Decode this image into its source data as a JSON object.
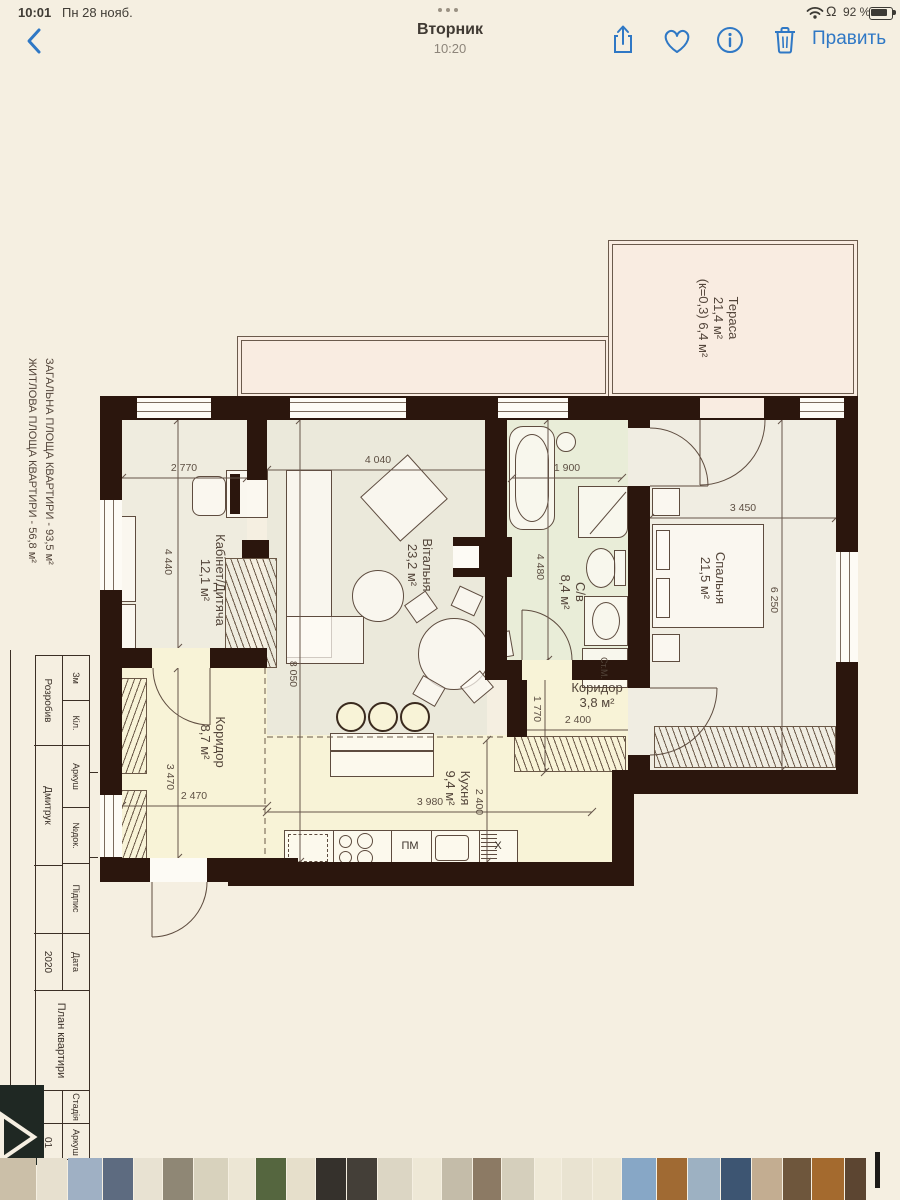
{
  "status_bar": {
    "time": "10:01",
    "date": "Пн 28 нояб.",
    "battery_percent": "92 %"
  },
  "nav": {
    "title": "Вторник",
    "subtitle": "10:20",
    "edit_label": "Править"
  },
  "plan": {
    "side_note_line1": "ЗАГАЛЬНА ПЛОЩА КВАРТИРИ - 93,5 м²",
    "side_note_line2": "ЖИТЛОВА ПЛОЩА КВАРТИРИ - 56,8 м²",
    "rooms": {
      "office": {
        "name": "Кабінет/Дитяча",
        "area": "12,1 м²"
      },
      "living": {
        "name": "Вітальня",
        "area": "23,2 м²"
      },
      "bath": {
        "name": "С/в",
        "area": "8,4 м²"
      },
      "bedroom": {
        "name": "Спальня",
        "area": "21,5 м²"
      },
      "hall": {
        "name": "Коридор",
        "area": "8,7 м²"
      },
      "hall_small": {
        "name": "Коридор",
        "area": "3,8 м²"
      },
      "kitchen": {
        "name": "Кухня",
        "area": "9,4 м²"
      },
      "terrace": {
        "name": "Тераса",
        "area": "21,4 м²",
        "coeff": "(к=0,3) 6,4 м²"
      }
    },
    "dims": {
      "w_office": "2 770",
      "w_living": "4 040",
      "w_bath": "1 900",
      "w_bedroom": "3 450",
      "h_office": "4 440",
      "h_bath": "4 480",
      "h_bedroom": "6 250",
      "h_living": "8 050",
      "h_hall_small": "1 770",
      "w_hall_small": "2 400",
      "h_hall": "3 470",
      "w_hall": "2 470",
      "w_kitchen": "3 980",
      "h_kitchen": "2 400"
    },
    "appliances": {
      "dishwasher": "ПМ",
      "fridge": "Х",
      "washing_machine": "Ст.М."
    }
  },
  "title_block": {
    "h_zm": "Зм",
    "h_kil": "Кіл.",
    "h_arkush": "Аркуш",
    "h_doc": "№док.",
    "h_pidpys": "Підпис",
    "h_data": "Дата",
    "role": "Розробив",
    "author": "Дмитрук",
    "year": "2020",
    "doc_title": "План квартири",
    "stage_label": "Стадія",
    "sheet_label": "Аркуш",
    "sheet_no": "01"
  },
  "filmstrip": {
    "thumbs": [
      {
        "w": 36,
        "c": "#cbbfa8"
      },
      {
        "w": 30,
        "c": "#e7e0cf"
      },
      {
        "w": 34,
        "c": "#9fb0c4"
      },
      {
        "w": 30,
        "c": "#5d6b80"
      },
      {
        "w": 28,
        "c": "#e8e2d2"
      },
      {
        "w": 30,
        "c": "#8f8775"
      },
      {
        "w": 34,
        "c": "#d8d2bd"
      },
      {
        "w": 26,
        "c": "#ece6d4"
      },
      {
        "w": 30,
        "c": "#55663f"
      },
      {
        "w": 28,
        "c": "#e6dfcb"
      },
      {
        "w": 30,
        "c": "#35312c"
      },
      {
        "w": 30,
        "c": "#443f38"
      },
      {
        "w": 34,
        "c": "#dcd6c4"
      },
      {
        "w": 28,
        "c": "#eee8d6"
      },
      {
        "w": 30,
        "c": "#c4bca9"
      },
      {
        "w": 28,
        "c": "#8c7a64"
      },
      {
        "w": 32,
        "c": "#d5cfbc"
      },
      {
        "w": 26,
        "c": "#efe9d7"
      },
      {
        "w": 30,
        "c": "#e9e3d1"
      },
      {
        "w": 28,
        "c": "#ece6d3"
      },
      {
        "w": 34,
        "c": "#87a7c6"
      },
      {
        "w": 30,
        "c": "#a06a33"
      },
      {
        "w": 32,
        "c": "#9db1c2"
      },
      {
        "w": 30,
        "c": "#3d5572"
      },
      {
        "w": 30,
        "c": "#c3ad91"
      },
      {
        "w": 28,
        "c": "#6e563c"
      },
      {
        "w": 32,
        "c": "#a46a2e"
      },
      {
        "w": 30,
        "c": "#5c4531"
      },
      {
        "w": 28,
        "c": "#ece6d4"
      },
      {
        "w": 26,
        "c": "#e5dfcd"
      }
    ]
  }
}
